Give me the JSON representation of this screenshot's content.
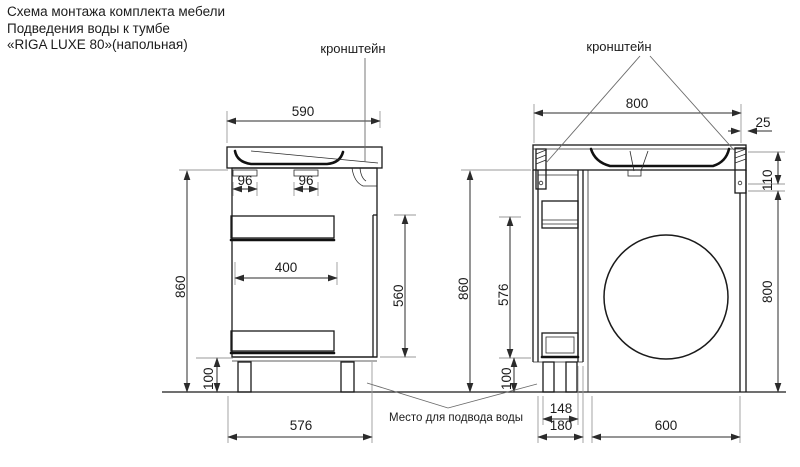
{
  "title": {
    "line1": "Схема монтажа комплекта мебели",
    "line2": "Подведения воды к тумбе",
    "line3": "«RIGA  LUXE 80»(напольная)"
  },
  "labels": {
    "bracket_left_view": "кронштейн",
    "bracket_right_view": "кронштейн",
    "water_supply_note": "Место для подвода воды"
  },
  "left_view": {
    "dims": {
      "sink_depth_top": "590",
      "rail_inset_front": "96",
      "rail_inset_mid": "96",
      "drawer_depth": "400",
      "drawer_zone_height": "560",
      "body_height": "860",
      "leg_height": "100",
      "base_depth_bottom": "576"
    }
  },
  "right_view": {
    "dims": {
      "top_width": "800",
      "bracket_edge_offset": "25",
      "bracket_drop": "110",
      "right_side_height": "800",
      "body_height": "860",
      "cabinet_inner_height": "576",
      "leg_height": "100",
      "cabinet_inner_width": "148",
      "cabinet_width": "180",
      "appliance_space_width": "600"
    }
  },
  "colors": {
    "background": "#ffffff",
    "outline": "#1a1a1a",
    "dimension": "#2b2b2b",
    "extension": "#9a9a9a",
    "text": "#1c1c1c"
  }
}
